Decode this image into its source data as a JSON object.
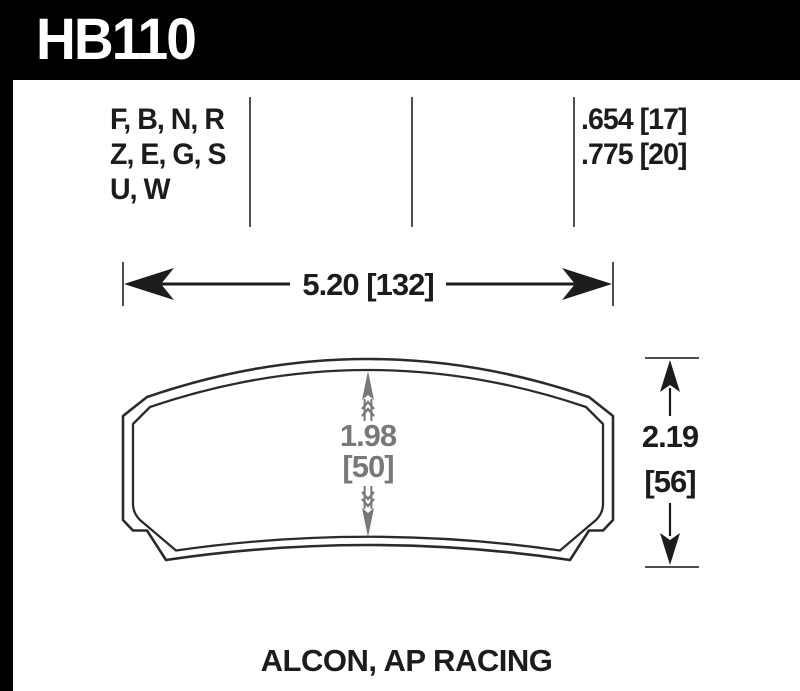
{
  "header": {
    "part_number": "HB110"
  },
  "spec_table": {
    "compounds": [
      "F, B, N, R",
      "Z, E, G, S",
      "U, W"
    ],
    "thicknesses": [
      ".654 [17]",
      ".775 [20]"
    ]
  },
  "dimensions": {
    "width_label": "5.20 [132]",
    "height_in": "2.19",
    "height_mm": "[56]",
    "center_in": "1.98",
    "center_mm": "[50]"
  },
  "footer": {
    "applications": "ALCON, AP RACING"
  },
  "colors": {
    "header-bg": "#000000",
    "header-text": "#ffffff",
    "panel-bg": "#ffffff",
    "ink": "#1c1c1c",
    "outline": "#2b2b2b",
    "divider": "#4d4d4d",
    "dim-gray": "#77787a"
  }
}
